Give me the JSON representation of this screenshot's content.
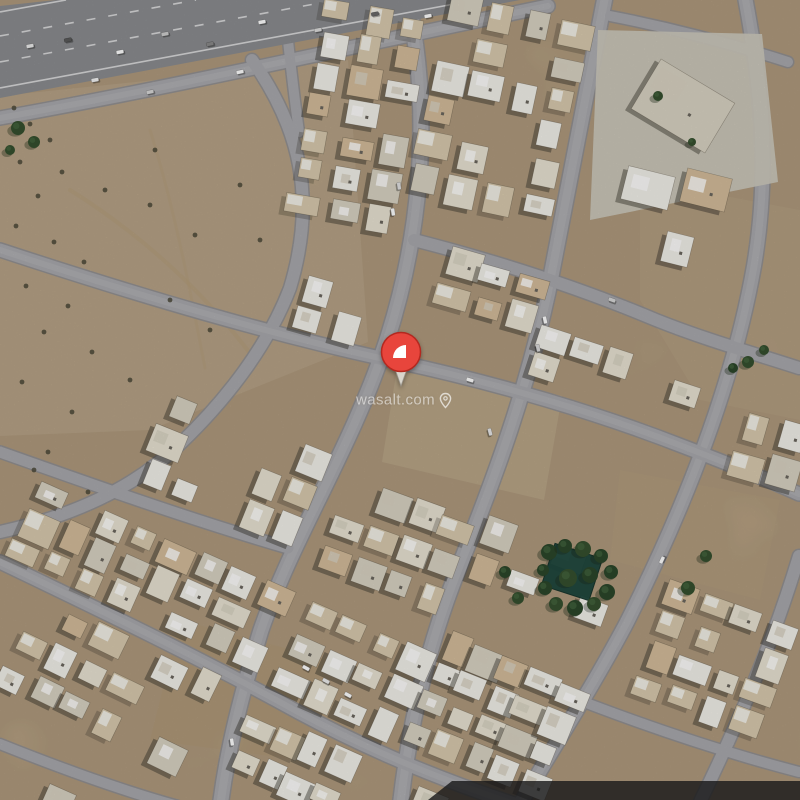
{
  "map": {
    "type": "satellite-imagery",
    "description": "aerial view of desert residential neighborhood with curved streets",
    "watermark": {
      "text": "wasalt.com",
      "icon": "location-pin-icon",
      "x": 404,
      "y": 400
    },
    "pin": {
      "x": 401,
      "y": 388,
      "color": "#e8453c",
      "rim": "#b4281f",
      "logo_color": "#ffffff",
      "tail_color": "#d9d5cc"
    },
    "colors": {
      "sand": "#c9b190",
      "road": "#a9a9ad",
      "road_casing": "#8f8f93",
      "road_center": "#b7b6ba",
      "highway": "#8b8d90",
      "lane_paint": "#e6e6e8",
      "roof_white": "#f3f1ea",
      "roof_offwhite": "#e9e3d3",
      "roof_gray": "#d9d3c3",
      "roof_tan": "#d4bd9b",
      "courtyard": "#d9cbae",
      "shadow": "#2e2a24",
      "tree_dark": "#2c472b",
      "tree_light": "#35512f",
      "pool": "#1b453c",
      "overlay_band": "#161618"
    },
    "overlay_band": {
      "points": "452,781 800,781 800,800 428,800",
      "opacity": 0.8
    },
    "highway": {
      "polygon": "0,6 56,0 520,0 0,98",
      "lines": [
        {
          "d": "M 0,12 L 66,0",
          "dash": false
        },
        {
          "d": "M 0,36 L 196,0",
          "dash": true
        },
        {
          "d": "M 0,62 L 336,0",
          "dash": true
        },
        {
          "d": "M 0,88 L 476,0",
          "dash": false
        }
      ]
    },
    "pad": {
      "polygon": "598,30 762,34 778,182 590,220",
      "fill": "#cdc9bd",
      "buildings": [
        {
          "cx": 683,
          "cy": 106,
          "w": 86,
          "h": 58,
          "angle": 31
        },
        {
          "cx": 648,
          "cy": 188,
          "w": 48,
          "h": 34,
          "angle": 14
        },
        {
          "cx": 706,
          "cy": 190,
          "w": 46,
          "h": 34,
          "angle": 14
        }
      ]
    },
    "streets": [
      {
        "name": "service-road",
        "d": "M 0,118 C 190,84 372,42 548,6",
        "w": 13
      },
      {
        "name": "stub-street",
        "d": "M 283,-6 C 288,42 293,88 299,132",
        "w": 10
      },
      {
        "name": "ring-a",
        "d": "M 252,60 C 300,128 317,198 290,288 C 268,346 226,400 180,444 C 130,492 64,518 0,532",
        "w": 12
      },
      {
        "name": "ring-b-pin-street",
        "d": "M 406,-8 C 436,122 416,250 387,340 C 351,450 295,532 261,630 C 242,692 227,750 220,808",
        "w": 15
      },
      {
        "name": "ring-c",
        "d": "M 606,-8 C 584,102 566,202 548,292 C 526,392 497,472 461,562 C 429,642 410,718 400,808",
        "w": 15
      },
      {
        "name": "ring-d",
        "d": "M 744,-8 C 762,84 770,172 754,266 C 733,385 686,505 627,622 C 589,694 550,752 518,808",
        "w": 14
      },
      {
        "name": "ring-e",
        "d": "M 799,556 C 772,646 736,728 698,806",
        "w": 12
      },
      {
        "name": "radial-top",
        "d": "M 610,16 C 672,28 732,44 788,62",
        "w": 10
      },
      {
        "name": "radial-north",
        "d": "M 414,240 C 500,262 580,288 656,320 C 706,340 756,354 799,368",
        "w": 12
      },
      {
        "name": "radial-pin",
        "d": "M 0,250 C 140,296 268,334 398,362 C 500,384 600,414 682,446 C 724,462 764,478 799,494",
        "w": 13
      },
      {
        "name": "radial-mid",
        "d": "M 0,452 C 96,486 192,520 288,548",
        "w": 11
      },
      {
        "name": "radial-south",
        "d": "M 0,562 C 100,610 208,662 298,712 C 376,754 448,782 520,806",
        "w": 13
      },
      {
        "name": "radial-corner",
        "d": "M 0,744 C 60,768 120,790 178,806",
        "w": 10
      },
      {
        "name": "radial-southeast",
        "d": "M 548,688 C 638,724 722,752 799,772",
        "w": 10
      }
    ],
    "tracks": [
      {
        "d": "M 70,190 C 150,240 210,300 252,356, ",
        "w": 4,
        "op": 0.4
      },
      {
        "d": "M 150,130 C 175,210 190,290 205,368",
        "w": 3,
        "op": 0.3
      }
    ],
    "patches": [
      {
        "pts": "0,96 348,60 368,342 150,430 0,436",
        "fill": "#d9c3a2",
        "op": 0.55
      },
      {
        "pts": "398,362 562,396 544,500 382,462",
        "fill": "#dcc6a4",
        "op": 0.6
      },
      {
        "pts": "640,180 800,210 800,420 700,400 640,300",
        "fill": "#d7bb9a",
        "op": 0.4
      },
      {
        "pts": "180,620 330,660 300,760 150,740",
        "fill": "#c8ab85",
        "op": 0.3
      },
      {
        "pts": "620,470 780,500 760,600 610,560",
        "fill": "#d2b696",
        "op": 0.35
      }
    ],
    "blocks": [
      {
        "cx": 360,
        "cy": 115,
        "w": 118,
        "h": 225,
        "angle": 10,
        "density": 0.82
      },
      {
        "cx": 500,
        "cy": 108,
        "w": 150,
        "h": 210,
        "angle": 12,
        "density": 0.82
      },
      {
        "cx": 492,
        "cy": 292,
        "w": 105,
        "h": 66,
        "angle": 16,
        "density": 0.85
      },
      {
        "cx": 330,
        "cy": 310,
        "w": 70,
        "h": 58,
        "angle": 16,
        "density": 0.9
      },
      {
        "cx": 595,
        "cy": 372,
        "w": 140,
        "h": 58,
        "angle": 18,
        "density": 0.8
      },
      {
        "cx": 697,
        "cy": 400,
        "w": 58,
        "h": 50,
        "angle": 18,
        "density": 0.8
      },
      {
        "cx": 764,
        "cy": 470,
        "w": 75,
        "h": 110,
        "angle": 16,
        "density": 0.8
      },
      {
        "cx": 396,
        "cy": 545,
        "w": 140,
        "h": 110,
        "angle": 20,
        "density": 0.9
      },
      {
        "cx": 235,
        "cy": 470,
        "w": 180,
        "h": 110,
        "angle": 22,
        "density": 0.75
      },
      {
        "cx": 150,
        "cy": 575,
        "w": 280,
        "h": 90,
        "angle": 24,
        "density": 0.82
      },
      {
        "cx": 108,
        "cy": 682,
        "w": 210,
        "h": 115,
        "angle": 26,
        "density": 0.85
      },
      {
        "cx": 40,
        "cy": 790,
        "w": 80,
        "h": 36,
        "angle": 24,
        "density": 0.85
      },
      {
        "cx": 352,
        "cy": 672,
        "w": 140,
        "h": 110,
        "angle": 24,
        "density": 0.9
      },
      {
        "cx": 292,
        "cy": 764,
        "w": 120,
        "h": 75,
        "angle": 24,
        "density": 0.85
      },
      {
        "cx": 395,
        "cy": 790,
        "w": 110,
        "h": 30,
        "angle": 22,
        "density": 0.8
      },
      {
        "cx": 495,
        "cy": 715,
        "w": 155,
        "h": 125,
        "angle": 22,
        "density": 0.88
      },
      {
        "cx": 540,
        "cy": 590,
        "w": 150,
        "h": 110,
        "angle": 20,
        "density": 0.55
      },
      {
        "cx": 715,
        "cy": 660,
        "w": 140,
        "h": 130,
        "angle": 20,
        "density": 0.85
      },
      {
        "cx": 660,
        "cy": 248,
        "w": 60,
        "h": 44,
        "angle": 14,
        "density": 0.7
      }
    ],
    "garden": {
      "cx": 572,
      "cy": 572,
      "w": 50,
      "h": 44,
      "angle": 18
    },
    "garden_trees": [
      [
        549,
        552,
        8
      ],
      [
        565,
        546,
        7
      ],
      [
        583,
        549,
        8
      ],
      [
        601,
        556,
        7
      ],
      [
        611,
        572,
        7
      ],
      [
        607,
        592,
        8
      ],
      [
        594,
        604,
        7
      ],
      [
        575,
        608,
        8
      ],
      [
        556,
        604,
        7
      ],
      [
        545,
        588,
        7
      ],
      [
        543,
        570,
        6
      ],
      [
        568,
        578,
        9
      ],
      [
        590,
        575,
        8
      ]
    ],
    "trees": [
      [
        18,
        128,
        7
      ],
      [
        34,
        142,
        6
      ],
      [
        10,
        150,
        5
      ],
      [
        505,
        572,
        6
      ],
      [
        518,
        598,
        6
      ],
      [
        688,
        588,
        7
      ],
      [
        706,
        556,
        6
      ],
      [
        748,
        362,
        6
      ],
      [
        764,
        350,
        5
      ],
      [
        658,
        96,
        5
      ],
      [
        692,
        142,
        4
      ],
      [
        733,
        368,
        5
      ]
    ],
    "shrubs": [
      [
        14,
        108
      ],
      [
        30,
        124
      ],
      [
        50,
        140
      ],
      [
        20,
        162
      ],
      [
        62,
        172
      ],
      [
        38,
        196
      ],
      [
        16,
        226
      ],
      [
        54,
        242
      ],
      [
        84,
        262
      ],
      [
        26,
        286
      ],
      [
        68,
        306
      ],
      [
        44,
        332
      ],
      [
        92,
        352
      ],
      [
        22,
        382
      ],
      [
        72,
        412
      ],
      [
        48,
        452
      ],
      [
        88,
        492
      ],
      [
        34,
        470
      ],
      [
        150,
        205
      ],
      [
        195,
        235
      ],
      [
        240,
        185
      ],
      [
        170,
        300
      ],
      [
        210,
        330
      ],
      [
        130,
        380
      ],
      [
        260,
        240
      ],
      [
        155,
        150
      ],
      [
        105,
        190
      ]
    ],
    "cars": [
      [
        30,
        46,
        -11,
        "#ececec"
      ],
      [
        68,
        40,
        -11,
        "#5a5a5a"
      ],
      [
        120,
        52,
        -11,
        "#ffffff"
      ],
      [
        165,
        34,
        -11,
        "#cfcfcf"
      ],
      [
        210,
        44,
        -11,
        "#8a8a8a"
      ],
      [
        262,
        22,
        -11,
        "#ffffff"
      ],
      [
        318,
        30,
        -11,
        "#dddddd"
      ],
      [
        375,
        14,
        -11,
        "#6a6a6a"
      ],
      [
        428,
        16,
        -11,
        "#ffffff"
      ],
      [
        95,
        80,
        -11,
        "#f4f4f4"
      ],
      [
        150,
        92,
        -12,
        "#d8d8d8"
      ],
      [
        240,
        72,
        -12,
        "#ffffff"
      ],
      [
        393,
        212,
        82,
        "#ffffff"
      ],
      [
        399,
        186,
        82,
        "#e2e2e2"
      ],
      [
        545,
        320,
        78,
        "#ffffff"
      ],
      [
        538,
        348,
        78,
        "#dcdcdc"
      ],
      [
        306,
        668,
        28,
        "#ffffff"
      ],
      [
        326,
        681,
        28,
        "#ededed"
      ],
      [
        348,
        695,
        28,
        "#ffffff"
      ],
      [
        470,
        380,
        17,
        "#ffffff"
      ],
      [
        612,
        300,
        20,
        "#d8d8d8"
      ],
      [
        662,
        560,
        -65,
        "#ffffff"
      ],
      [
        232,
        742,
        82,
        "#ffffff"
      ],
      [
        490,
        432,
        75,
        "#e8e8e8"
      ]
    ]
  }
}
